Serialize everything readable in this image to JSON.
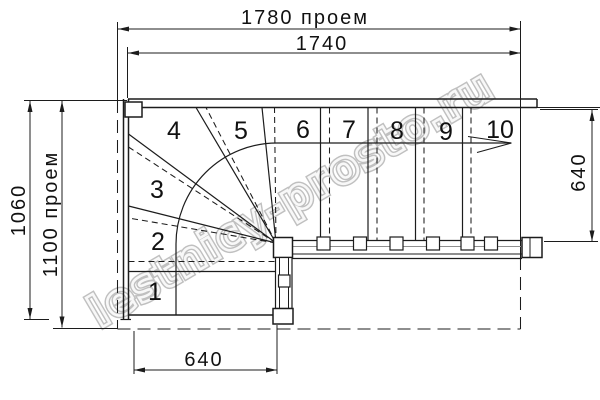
{
  "drawing": {
    "type": "staircase floor plan, top view, 10 steps with winder turn",
    "steps": [
      "1",
      "2",
      "3",
      "4",
      "5",
      "6",
      "7",
      "8",
      "9",
      "10"
    ]
  },
  "dimensions": {
    "top_opening": "1780 проем",
    "top_stair_length": "1740",
    "left_outer": "1060",
    "left_opening": "1100 проем",
    "right_flight_width": "640",
    "bottom_flight_width": "640"
  },
  "watermark": {
    "text": "lestnicy-prosto.ru"
  },
  "colors": {
    "line": "#1c1c1c",
    "rail_mid_line": "#8f8f8f",
    "watermark_outline": "#ababab",
    "background": "#ffffff"
  }
}
